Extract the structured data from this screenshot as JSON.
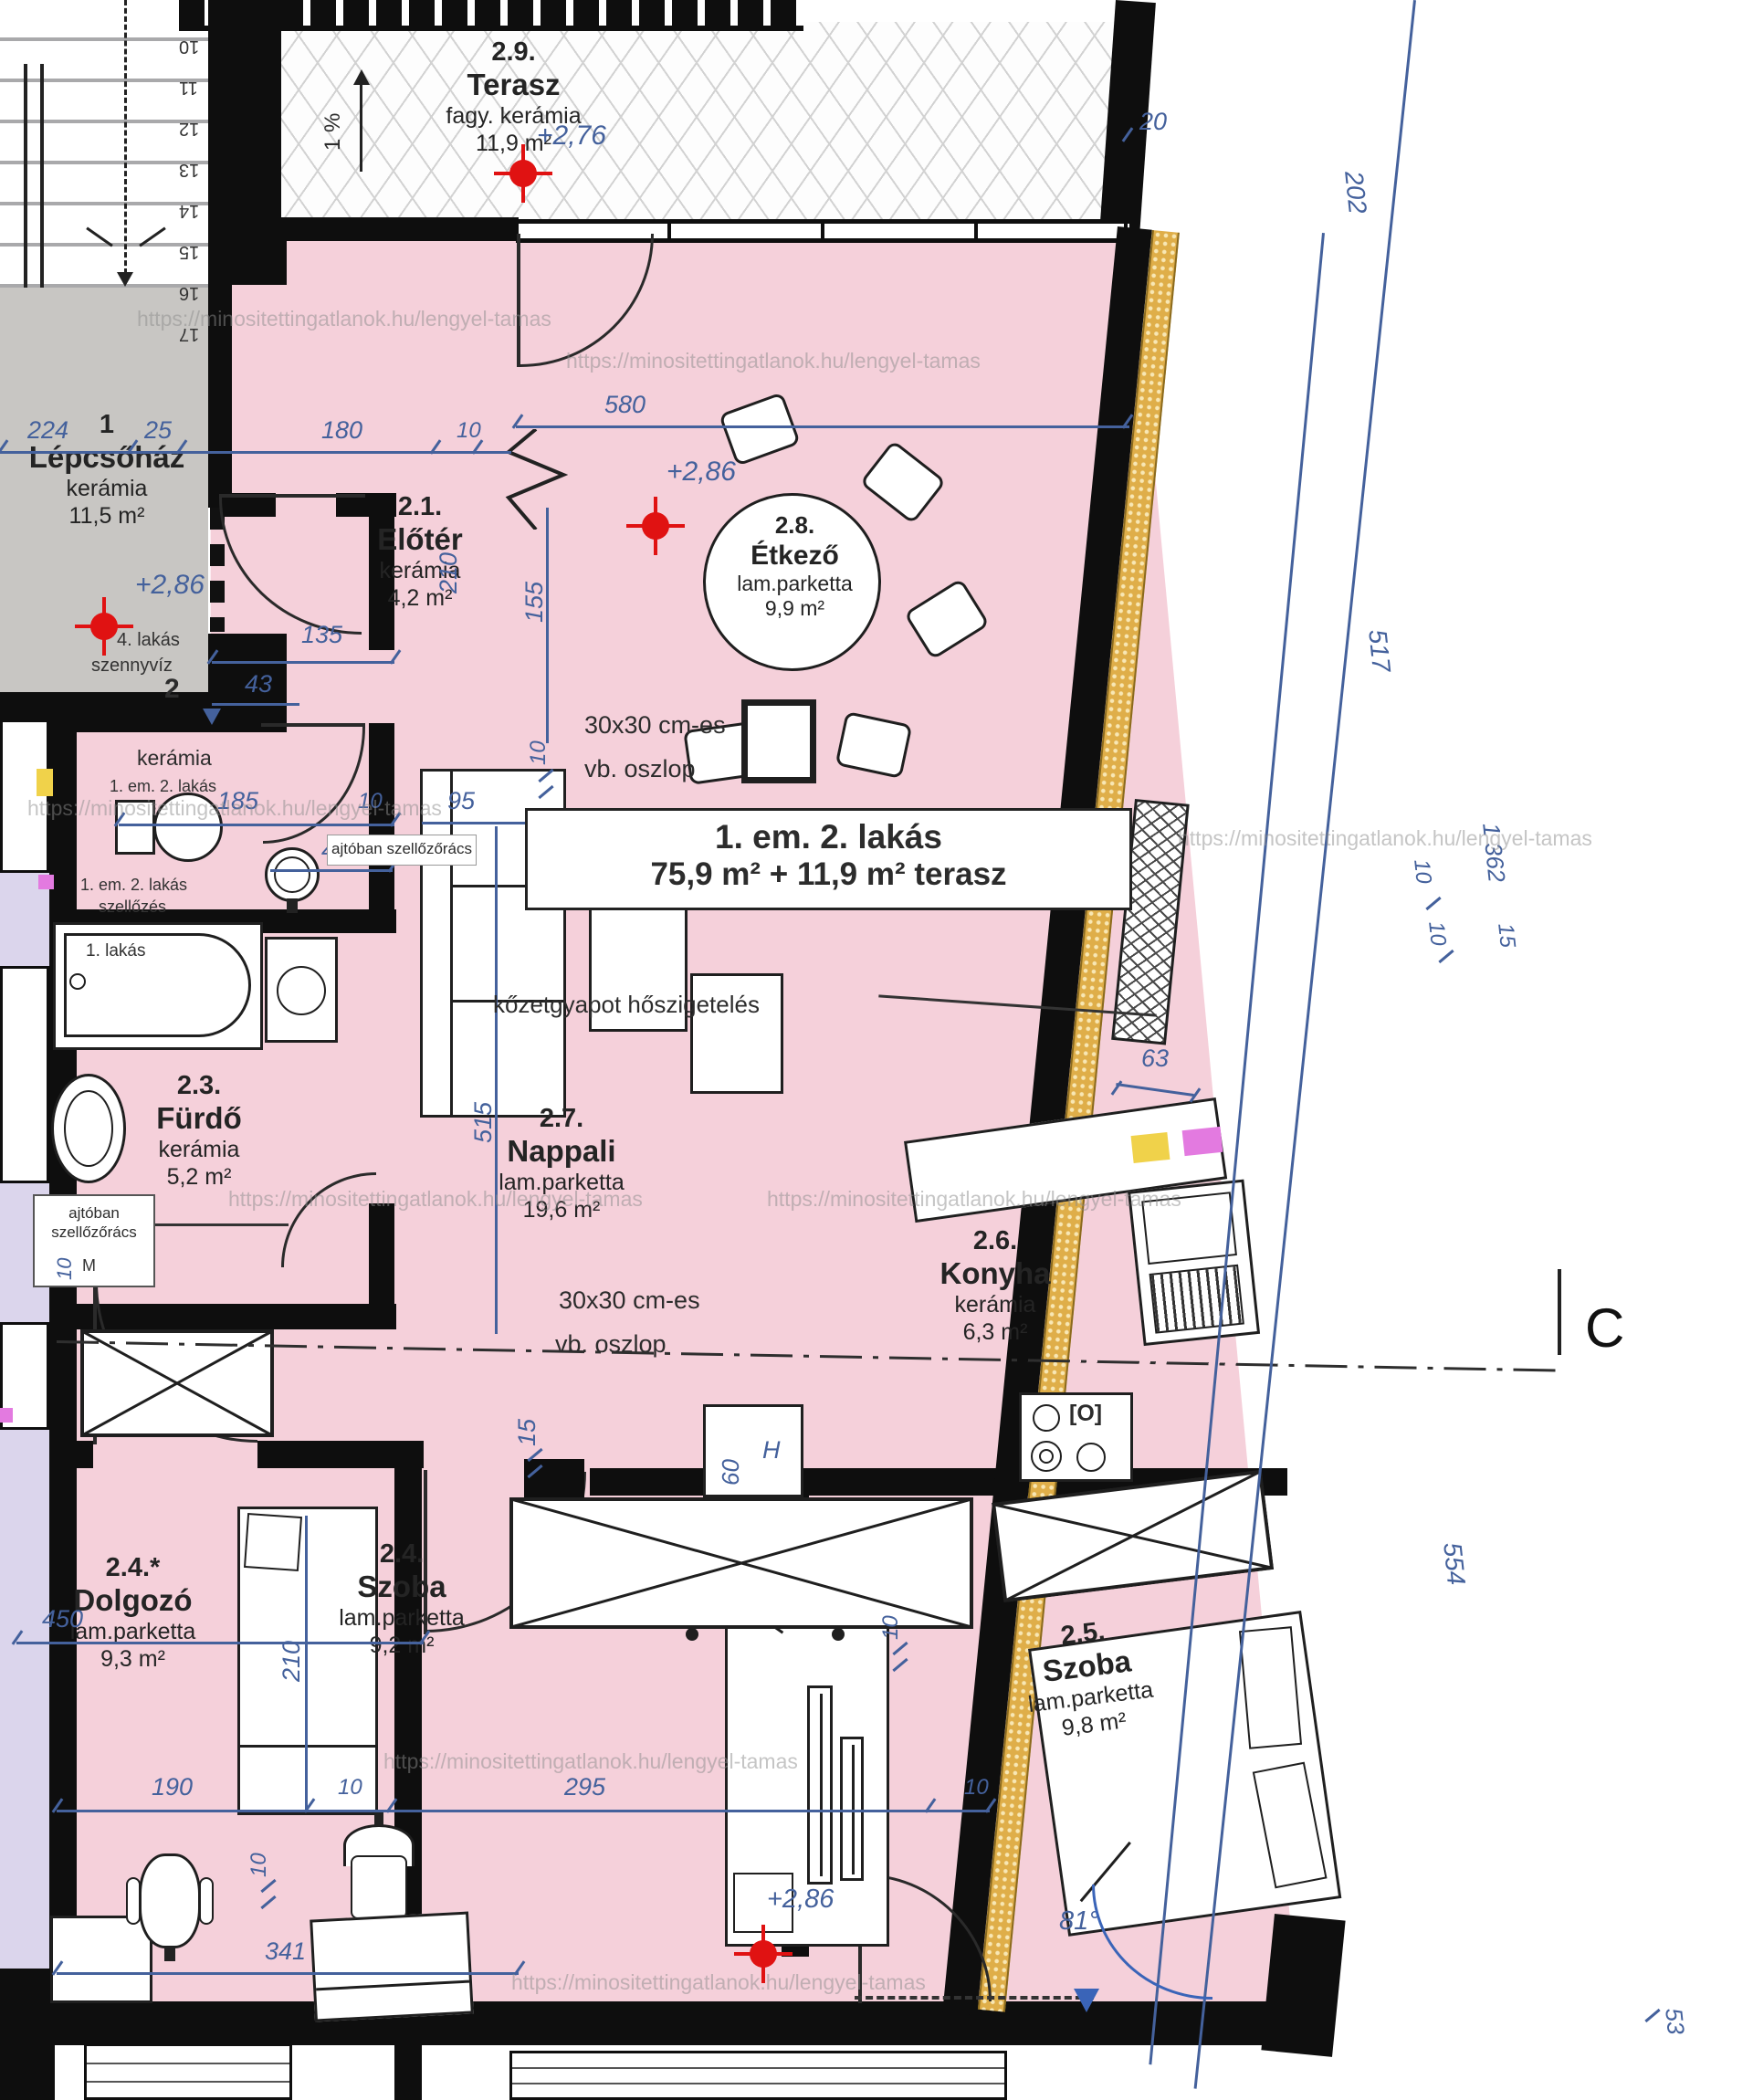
{
  "watermark": "https://minositettingatlanok.hu/lengyel-tamas",
  "title_box": {
    "line1": "1. em. 2. lakás",
    "line2": "75,9 m² + 11,9 m² terasz"
  },
  "rooms": {
    "stairwell": {
      "number": "1",
      "name": "Lépcsőház",
      "material": "kerámia",
      "area": "11,5 m²"
    },
    "eloter": {
      "number": "2.1.",
      "name": "Előtér",
      "material": "kerámia",
      "area": "4,2 m²"
    },
    "wc": {
      "material": "kerámia",
      "area": "2,1 m²"
    },
    "furdo": {
      "number": "2.3.",
      "name": "Fürdő",
      "material": "kerámia",
      "area": "5,2 m²"
    },
    "dolgozo": {
      "number": "2.4.*",
      "name": "Dolgozó",
      "material": "lam.parketta",
      "area": "9,3 m²"
    },
    "szoba24": {
      "number": "2.4.",
      "name": "Szoba",
      "material": "lam.parketta",
      "area": "9,2 m²"
    },
    "szoba25": {
      "number": "2.5.",
      "name": "Szoba",
      "material": "lam.parketta",
      "area": "9,8 m²"
    },
    "konyha": {
      "number": "2.6.",
      "name": "Konyha",
      "material": "kerámia",
      "area": "6,3 m²"
    },
    "nappali": {
      "number": "2.7.",
      "name": "Nappali",
      "material": "lam.parketta",
      "area": "19,6 m²"
    },
    "etkezo": {
      "number": "2.8.",
      "name": "Étkező",
      "material": "lam.parketta",
      "area": "9,9 m²"
    },
    "terasz": {
      "number": "2.9.",
      "name": "Terasz",
      "material": "fagy. kerámia",
      "area": "11,9 m²"
    }
  },
  "annotations": {
    "column_note_1": "30x30 cm-es",
    "column_note_2": "vb. oszlop",
    "insulation_note": "kőzetgyapot hőszigetelés",
    "door_vent_note": "ajtóban szellőzőrács",
    "slope": "1 %",
    "riser_sewage_1": "4. lakás",
    "riser_sewage_2": "szennyvíz",
    "riser_sewage_num": "2",
    "riser_vent_1": "1. em. 2. lakás",
    "riser_vent_2": "szellőzés",
    "riser_wc": "1. em. 2. lakás",
    "bath_note": "1. lakás",
    "fridge": "H",
    "m_mark": "M",
    "section_letter": "C",
    "angle": "81°"
  },
  "levels": {
    "terasz": "+2,76",
    "floor": "+2,86"
  },
  "dims": {
    "d224": "224",
    "d25": "25",
    "d180": "180",
    "d10": "10",
    "d580": "580",
    "d20": "20",
    "d202": "202",
    "d135": "135",
    "d43": "43",
    "d185": "185",
    "d210": "210",
    "d155": "155",
    "d95": "95",
    "d515": "515",
    "d15": "15",
    "d63": "63",
    "d60": "60",
    "d517": "517",
    "d1362": "1 362",
    "d554": "554",
    "d53": "53",
    "d450": "450",
    "d190": "190",
    "d295": "295",
    "d341": "341"
  },
  "stairs": {
    "numbers": [
      "10",
      "11",
      "12",
      "13",
      "14",
      "15",
      "16",
      "17"
    ]
  }
}
